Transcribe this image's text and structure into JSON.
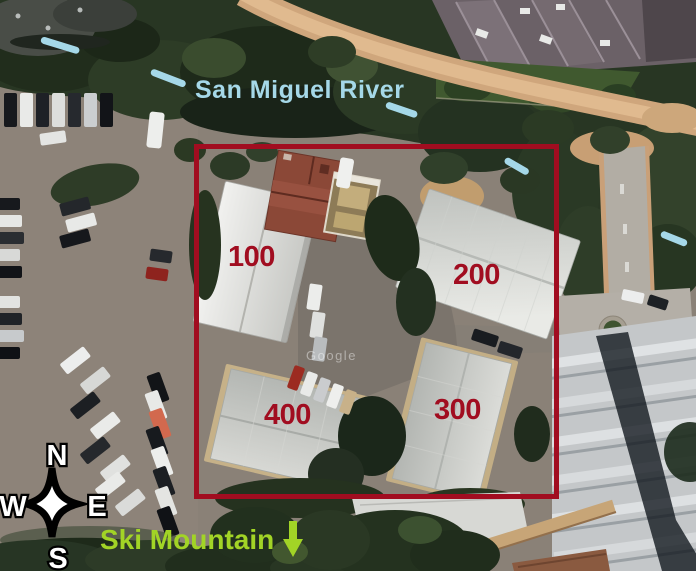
{
  "title": "Annotated satellite map",
  "colors": {
    "annotation_red": "#a10d20",
    "flow_blue": "#a5d8e8",
    "ski_green": "#a2d426",
    "compass_fill": "#ffffff",
    "compass_outline": "#000000"
  },
  "map": {
    "imagery_watermark": "Google",
    "river_label": "San Miguel River",
    "ski_label": "Ski Mountain",
    "building_labels": [
      {
        "text": "100"
      },
      {
        "text": "200"
      },
      {
        "text": "300"
      },
      {
        "text": "400"
      }
    ],
    "compass": {
      "north": "N",
      "south": "S",
      "east": "E",
      "west": "W"
    },
    "icons": [
      {
        "name": "compass-rose-icon",
        "meaning": "four-pointed compass star with N S E W"
      },
      {
        "name": "down-arrow-icon",
        "meaning": "points toward ski mountain south of map"
      },
      {
        "name": "flow-dash-icon",
        "meaning": "light blue river flow tick",
        "count": 5
      }
    ]
  }
}
